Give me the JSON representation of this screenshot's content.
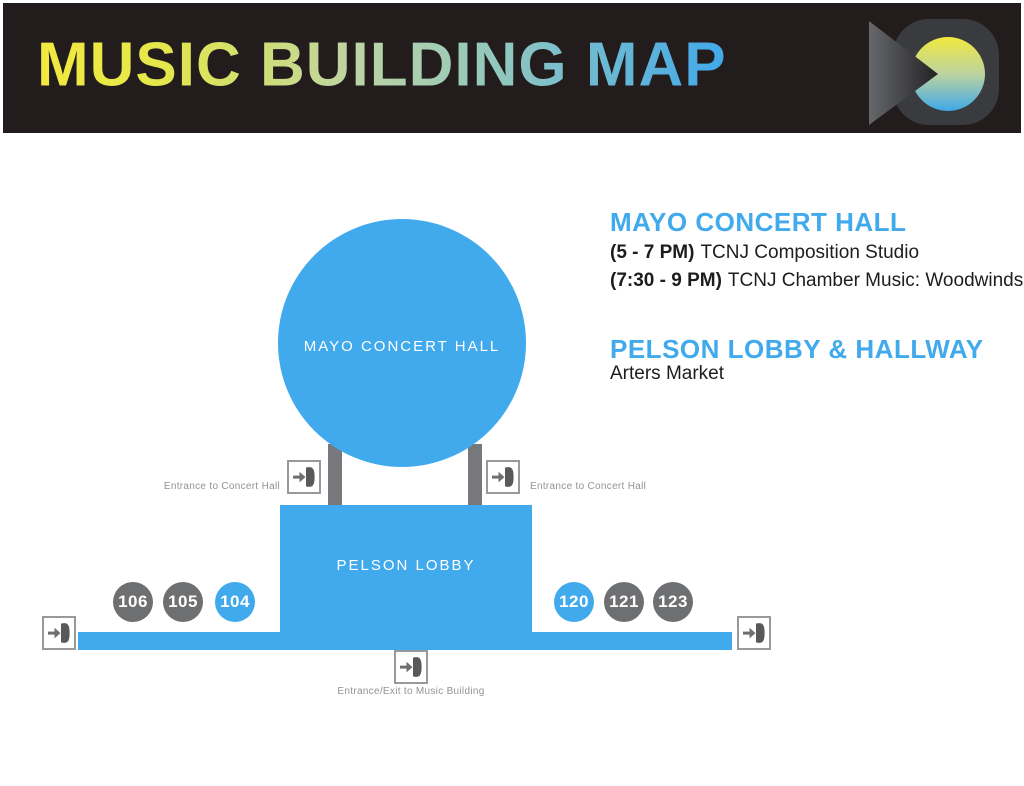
{
  "header": {
    "title": "MUSIC BUILDING MAP",
    "bg_color": "#221c1d",
    "title_gradient": [
      "#f2e93f",
      "#bdd4a4",
      "#45aae8"
    ],
    "logo_colors": {
      "blob_gray": "#3a3b3f",
      "triangle_dark": "#59595c",
      "circle_yellow": "#f0e93e",
      "circle_blue": "#3fa9e8"
    }
  },
  "map": {
    "concert_hall_label": "MAYO CONCERT HALL",
    "lobby_label": "PELSON LOBBY",
    "rooms": [
      {
        "number": "106",
        "highlight": false
      },
      {
        "number": "105",
        "highlight": false
      },
      {
        "number": "104",
        "highlight": true
      },
      {
        "number": "120",
        "highlight": true
      },
      {
        "number": "121",
        "highlight": false
      },
      {
        "number": "123",
        "highlight": false
      }
    ],
    "entrance_left_label": "Entrance to Concert Hall",
    "entrance_right_label": "Entrance to Concert Hall",
    "entrance_bottom_label": "Entrance/Exit to Music Building",
    "colors": {
      "shape_blue": "#41aaec",
      "shape_gray": "#6e6f71",
      "connector_gray": "#77787b",
      "label_gray": "#909296"
    }
  },
  "schedule": {
    "sections": [
      {
        "heading": "MAYO CONCERT HALL",
        "events": [
          {
            "time": "(5 - 7 PM)",
            "title": "TCNJ Composition Studio"
          },
          {
            "time": "(7:30 - 9 PM)",
            "title": "TCNJ Chamber Music: Woodwinds"
          }
        ]
      },
      {
        "heading": "PELSON LOBBY & HALLWAY",
        "events": [
          {
            "time": "",
            "title": "Arters Market"
          }
        ]
      }
    ]
  }
}
